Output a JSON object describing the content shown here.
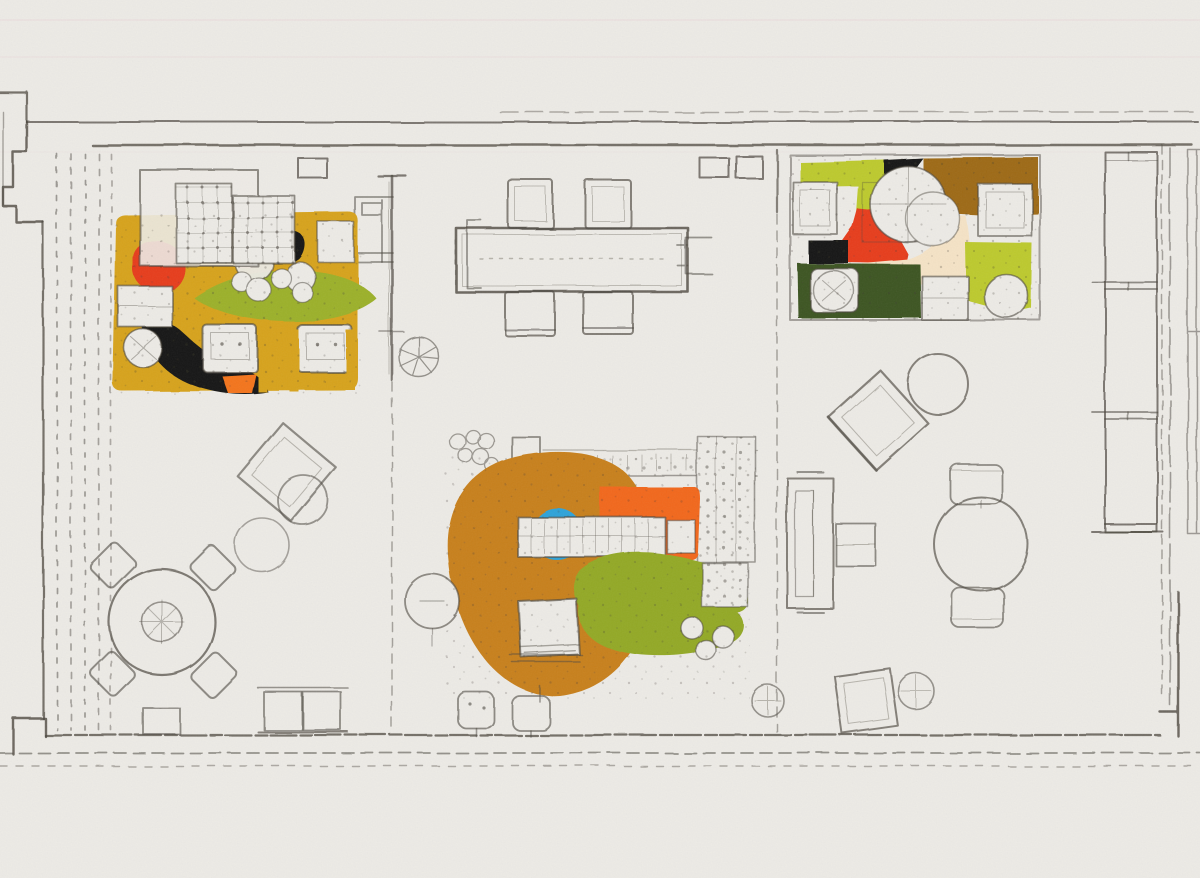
{
  "meta": {
    "title": "Hand-drawn interior floor plan sketch with three colored furniture groupings",
    "kind": "floor-plan-sketch"
  },
  "canvas": {
    "width": 1200,
    "height": 878
  },
  "palette": {
    "paper": "#edebe6",
    "pencil": "#4c473f",
    "mustard": "#d7a31c",
    "ochre": "#c8801f",
    "orange": "#f4741e",
    "orange_bright": "#f2671d",
    "red": "#e73d1f",
    "leaf_green": "#9cb12c",
    "olive_green": "#93a928",
    "lime": "#bdca2e",
    "dark_green": "#3c5522",
    "brown": "#9e6a17",
    "cream": "#f5e3c6",
    "blue": "#2fa3d9",
    "ink_black": "#191915",
    "scanline": "#e9c9ce"
  },
  "zones": {
    "topleft_lounge": "colored lounge group top-left",
    "topright_lounge": "colored lounge group top-right",
    "center_lounge": "colored sofa group center",
    "conference": "rectangular table with chairs",
    "round_table_left": "round table with four chairs",
    "round_table_right": "round table with two chairs",
    "deck_stripes": "striped decking along left wall",
    "cabinet_right": "tall cabinet along right wall"
  }
}
